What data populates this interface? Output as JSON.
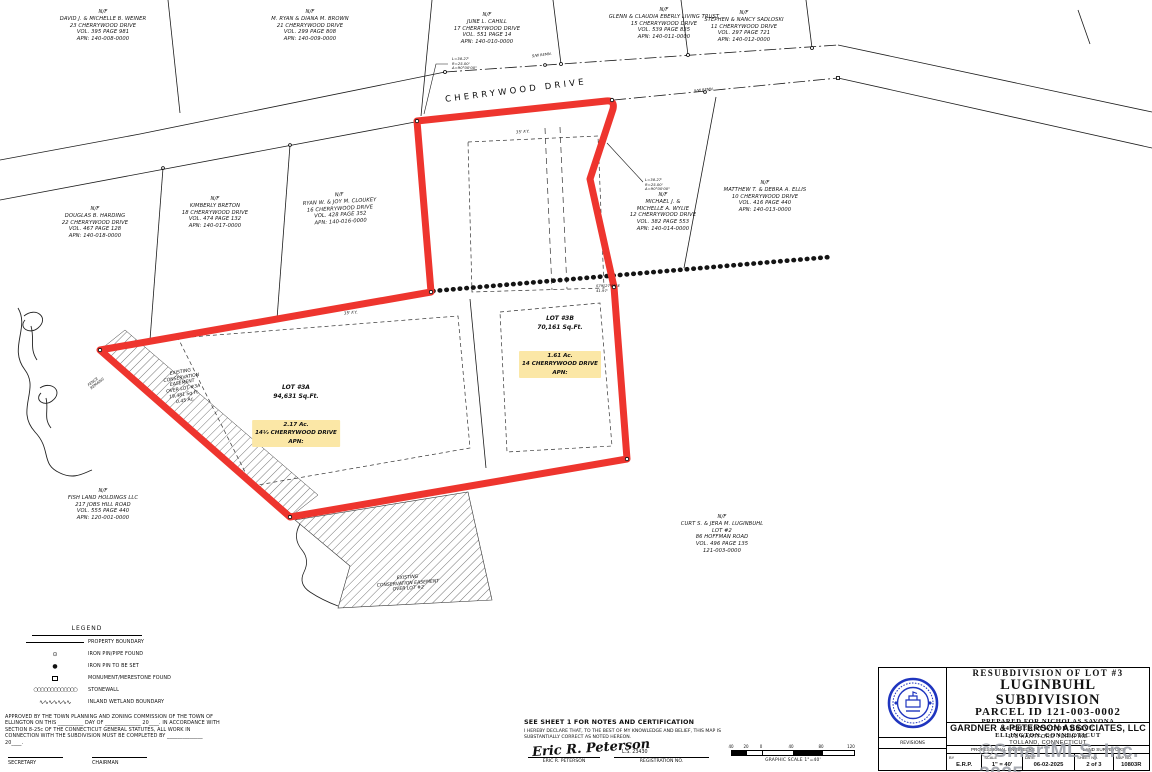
{
  "road": {
    "name": "CHERRYWOOD DRIVE"
  },
  "map": {
    "parcels": [
      "N/F\nDAVID J. & MICHELLE B. WEINER\n23 CHERRYWOOD DRIVE\nVOL. 395 PAGE 981\nAPN: 140-008-0000",
      "N/F\nM. RYAN & DIANA M. BROWN\n21 CHERRYWOOD DRIVE\nVOL. 299 PAGE 808\nAPN: 140-009-0000",
      "N/F\nJUNE L. CAHILL\n17 CHERRYWOOD DRIVE\nVOL. 551 PAGE 14\nAPN: 140-010-0000",
      "N/F\nGLENN & CLAUDIA EBERLY LIVING TRUST\n15 CHERRYWOOD DRIVE\nVOL. 539 PAGE 835\nAPN: 140-011-0000",
      "N/F\nSTEPHEN & NANCY SADLOSKI\n11 CHERRYWOOD DRIVE\nVOL. 297 PAGE 721\nAPN: 140-012-0000",
      "N/F\nDOUGLAS B. HARDING\n22 CHERRYWOOD DRIVE\nVOL. 467 PAGE 128\nAPN: 140-018-0000",
      "N/F\nKIMBERLY BRETON\n18 CHERRYWOOD DRIVE\nVOL. 474 PAGE 132\nAPN: 140-017-0000",
      "N/F\nRYAN W. & JOY M. CLOUKEY\n16 CHERRYWOOD DRIVE\nVOL. 428 PAGE 352\nAPN: 140-016-0000",
      "N/F\nMICHAEL J. &\nMICHELLE A. WYLIE\n12 CHERRYWOOD DRIVE\nVOL. 382 PAGE 553\nAPN: 140-014-0000",
      "N/F\nMATTHEW T. & DEBRA A. ELLIS\n10 CHERRYWOOD DRIVE\nVOL. 416 PAGE 440\nAPN: 140-013-0000",
      "N/F\nFISH LAND HOLDINGS LLC\n217 JOBS HILL ROAD\nVOL. 555 PAGE 440\nAPN: 120-001-0000",
      "N/F\nCURT S. & JERA M. LUGINBUHL\nLOT #2\n86 HOFFMAN ROAD\nVOL. 496 PAGE 135\n121-003-0000"
    ],
    "lots": {
      "b3": {
        "head": "LOT #3B\n70,161 Sq.Ft.",
        "hl": "1.61 Ac.\n14 CHERRYWOOD DRIVE\nAPN:"
      },
      "a3": {
        "head": "LOT #3A\n94,631 Sq.Ft.",
        "hl": "2.17 Ac.\n14½ CHERRYWOOD DRIVE\nAPN:"
      }
    },
    "easements": {
      "e3a": "EXISTING\nCONSERVATION\nEASEMENT\nOVER LOT #3A\n19,481 Sq.Ft.\n0.45 Ac.",
      "e2": "EXISTING\nCONSERVATION EASEMENT\nOVER LOT #2"
    },
    "notes": {
      "curve": "L=38.27'\nR=25.00'\nΔ=90°00'00\"",
      "bearing": "S79°27'09\"E\n41.97'",
      "fy": "35' F.Y.",
      "sw": "S/W REMN.",
      "fence": "FENCE\nREMAINS"
    }
  },
  "legend": {
    "title": "LEGEND",
    "items": [
      "PROPERTY BOUNDARY",
      "IRON PIN/PIPE FOUND",
      "IRON PIN TO BE SET",
      "MONUMENT/MERESTONE FOUND",
      "STONEWALL",
      "INLAND WETLAND BOUNDARY"
    ]
  },
  "approval": {
    "text": "APPROVED BY THE TOWN PLANNING AND ZONING COMMISSION OF THE TOWN OF ELLINGTON ON THIS __________ DAY OF ______________ 20____. IN ACCORDANCE WITH SECTION 8-25c OF THE CONNECTICUT GENERAL STATUTES, ALL WORK IN CONNECTION WITH THE SUBDIVISION MUST BE COMPLETED BY ______________ 20____.",
    "secretary": "SECRETARY",
    "chairman": "CHAIRMAN"
  },
  "certification": {
    "heading": "SEE SHEET 1 FOR NOTES AND CERTIFICATION",
    "body": "I HEREBY DECLARE THAT, TO THE BEST OF MY KNOWLEDGE AND BELIEF, THIS MAP IS SUBSTANTIALLY CORRECT AS NOTED HEREON.",
    "signature": "Eric R. Peterson",
    "name": "ERIC R. PETERSON",
    "reg_no": "L.S. 23430",
    "reg_label": "REGISTRATION NO."
  },
  "scalebar": {
    "ticks": [
      "40",
      "20",
      "0",
      "40",
      "80",
      "120"
    ],
    "caption": "GRAPHIC SCALE 1\"=40'"
  },
  "titleblock": {
    "title_small": "RESUBDIVISION OF LOT #3",
    "title_main": "LUGINBUHL SUBDIVISION",
    "parcel_id": "PARCEL ID 121-003-0002",
    "prepared_for": "PREPARED FOR NICHOLAS SAVONA",
    "address": "14 CHERRYWOOD DRIVE",
    "town": "ELLINGTON, CONNECTICUT",
    "firm": "GARDNER & PETERSON ASSOCIATES, LLC",
    "firm_addr1": "178 HARTFORD TURNPIKE",
    "firm_addr2": "TOLLAND, CONNECTICUT",
    "prof_left": "PROFESSIONAL ENGINEERS",
    "prof_right": "LAND SURVEYORS",
    "revisions": "REVISIONS",
    "fields": [
      {
        "label": "BY",
        "value": "E.R.P."
      },
      {
        "label": "SCALE",
        "value": "1\" = 40'"
      },
      {
        "label": "DATE",
        "value": "06-02-2025"
      },
      {
        "label": "SHEET NO.",
        "value": "2 of 3"
      },
      {
        "label": "MAP NO.",
        "value": "10803R"
      }
    ]
  },
  "watermark": {
    "text": "©SmartMLS, Inc. 2025"
  },
  "colors": {
    "boundary_red": "#ee352e",
    "highlight_yellow": "#fbe7a6",
    "seal_blue": "#1f35bf",
    "watermark_gray": "#9b9ea6"
  }
}
